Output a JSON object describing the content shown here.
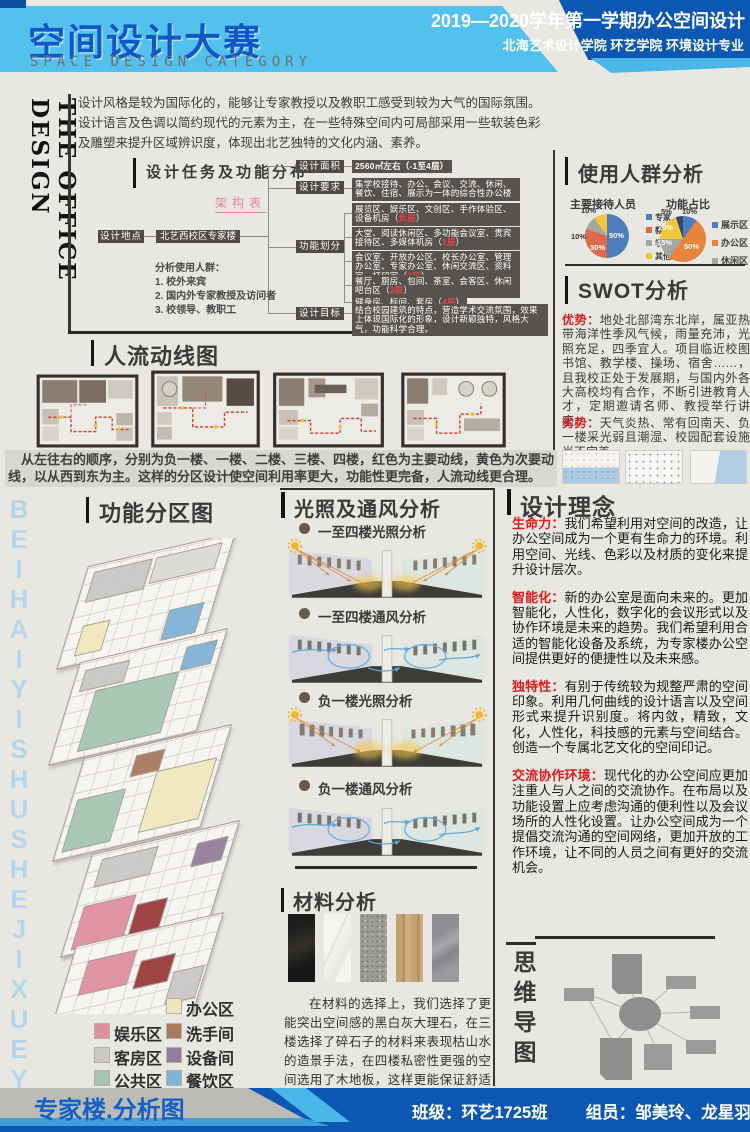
{
  "header": {
    "title": "空间设计大赛",
    "subtitle": "SPACE DESIGN CATEGORY",
    "term_line": "2019—2020学年第一学期办公空间设计",
    "school_line": "北海艺术设计学院  环艺学院  环境设计专业"
  },
  "side": {
    "vertical_title": "THE OFFICE DESIGN",
    "watermark": "BEIHAIYISHUSHEJIXUEYUAN"
  },
  "intro": {
    "text": "设计风格是较为国际化的，能够让专家教授以及教职工感受到较为大气的国际氛围。\n设计语言及色调以简约现代的元素为主，在一些特殊空间内可局部采用一些软装色彩及雕塑来提升区域辨识度，体现出北艺独特的文化内涵、素养。"
  },
  "task": {
    "title": "设计任务及功能分布",
    "subtitle": "架构表",
    "location_label": "设计地点",
    "location_value": "北艺西校区专家楼",
    "area_label": "设计面积",
    "area_value": "2560㎡左右（-1至4层）",
    "req_label": "设计要求",
    "req_value": "集学校接待、办公、会议、交流、休闲、餐饮、住宿、展示为一体的综合性办公楼",
    "func_label": "功能划分",
    "func_items": [
      {
        "text": "展览区、娱乐区、文创区、手作体验区、设备机房",
        "floor": "负层"
      },
      {
        "text": "大堂、阅读休闲区、多功能会议室、贵宾接待区、多媒体机房",
        "floor": "1层"
      },
      {
        "text": "会议室、开放办公区、校长办公室、管理办公室、专家办公室、休闲交流区、资料室、打印室",
        "floor": "2层"
      },
      {
        "text": "餐厅、厨房、包间、茶室、会客区、休闲吧台区",
        "floor": "3层"
      },
      {
        "text": "健身房、标间、套房",
        "floor": "4层"
      }
    ],
    "goal_label": "设计目标",
    "goal_value": "结合校园建筑的特点，营造学术交流氛围，效果上体现国际化的形象，设计新颖独特，风格大气，功能科学合理。",
    "note_title": "分析使用人群：",
    "note_items": [
      "1. 校外来宾",
      "2. 国内外专家教授及访问者",
      "3. 校领导、教职工"
    ]
  },
  "audience": {
    "section_title": "使用人群分析"
  },
  "chart_data": [
    {
      "type": "pie",
      "title": "主要接待人员",
      "legend_position": "right",
      "slices": [
        {
          "name": "专家",
          "value": 50,
          "label": "50%",
          "color": "#4e7dbb"
        },
        {
          "name": "教职工",
          "value": 30,
          "label": "30%",
          "color": "#dd6a4b"
        },
        {
          "name": "学生",
          "value": 10,
          "label": "10%",
          "color": "#a6a6a6"
        },
        {
          "name": "其他人员",
          "value": 10,
          "label": "10%",
          "color": "#f2c53d"
        }
      ]
    },
    {
      "type": "pie",
      "title": "功能占比",
      "legend_position": "right",
      "slices": [
        {
          "name": "展示区",
          "value": 10,
          "label": "10%",
          "color": "#4e7dbb"
        },
        {
          "name": "办公区",
          "value": 50,
          "label": "50%",
          "color": "#e8843c"
        },
        {
          "name": "休闲区",
          "value": 15,
          "label": "15%",
          "color": "#a6a6a6"
        },
        {
          "name": "",
          "value": 20,
          "label": "20%",
          "color": "#f2c53d"
        },
        {
          "name": "",
          "value": 5,
          "label": "5%",
          "color": "#31496e"
        }
      ]
    }
  ],
  "swot": {
    "section_title": "SWOT分析",
    "strengths_label": "优势：",
    "strengths": "地处北部湾东北岸，属亚热带海洋性季风气候，雨量充沛，光照充足，四季宜人。项目临近校图书馆、教学楼、操场、宿舍……，且我校正处于发展期，与国内外各大高校均有合作，不断引进教育人才，定期邀请名师、教授举行讲座。",
    "weaknesses_label": "劣势：",
    "weaknesses": "天气炎热、常有回南天、负一楼采光弱且潮湿、校园配套设施尚不完善。"
  },
  "circ": {
    "section_title": "人流动线图",
    "caption": "　从左往右的顺序，分别为负一楼、一楼、二楼、三楼、四楼，红色为主要动线，黄色为次要动线，以从西到东为主。这样的分区设计使空间利用率更大，功能性更完备，人流动线更合理。"
  },
  "zoning": {
    "section_title": "功能分区图",
    "legend": [
      {
        "label": "办公区",
        "color": "#efe8bf"
      },
      {
        "label": "娱乐区",
        "color": "#e08fa0"
      },
      {
        "label": "洗手间",
        "color": "#a87a5e"
      },
      {
        "label": "客房区",
        "color": "#c9c8c6"
      },
      {
        "label": "设备间",
        "color": "#957e9c"
      },
      {
        "label": "公共区",
        "color": "#a6c6b3"
      },
      {
        "label": "餐饮区",
        "color": "#7fb2d7"
      }
    ]
  },
  "light": {
    "section_title": "光照及通风分析",
    "items": [
      "一至四楼光照分析",
      "一至四楼通风分析",
      "负一楼光照分析",
      "负一楼通风分析"
    ]
  },
  "mat": {
    "section_title": "材料分析",
    "description": "在材料的选择上，我们选择了更能突出空间感的黑白灰大理石，在三楼选择了碎石子的材料来表现枯山水的造景手法，在四楼私密性更强的空间选用了木地板，这样更能保证舒适感。"
  },
  "concept": {
    "section_title": "设计理念",
    "items": [
      {
        "lead": "生命力：",
        "text": "我们希望利用对空间的改造，让办公空间成为一个更有生命力的环境。利用空间、光线、色彩以及材质的变化来提升设计层次。"
      },
      {
        "lead": "智能化：",
        "text": "新的办公室是面向未来的。更加智能化，人性化，数字化的会议形式以及协作环境是未来的趋势。我们希望利用合适的智能化设备及系统，为专家楼办公空间提供更好的便捷性以及未来感。"
      },
      {
        "lead": "独特性：",
        "text": "有别于传统较为规整严肃的空间印象。利用几何曲线的设计语言以及空间形式来提升识别度。将内敛，精致，文化，人性化，科技感的元素与空间结合。创造一个专属北艺文化的空间印记。"
      },
      {
        "lead": "交流协作环境：",
        "text": "现代化的办公空间应更加注重人与人之间的交流协作。在布局以及功能设置上应考虑沟通的便利性以及会议场所的人性化设置。让办公空间成为一个提倡交流沟通的空间网络，更加开放的工作环境，让不同的人员之间有更好的交流机会。"
      }
    ]
  },
  "mind": {
    "section_title": "思维导图"
  },
  "footer": {
    "board_title": "专家楼.分析图",
    "class_info": "班级：环艺1725班",
    "members_info": "组员：邹美玲、龙星羽、申成洁、付成军"
  },
  "colors": {
    "header_blue": "#0b57b4",
    "header_light_blue": "#53c1ee",
    "accent_red": "#e01a1a",
    "dark_box": "#57524d",
    "maroon": "#993c3c"
  }
}
